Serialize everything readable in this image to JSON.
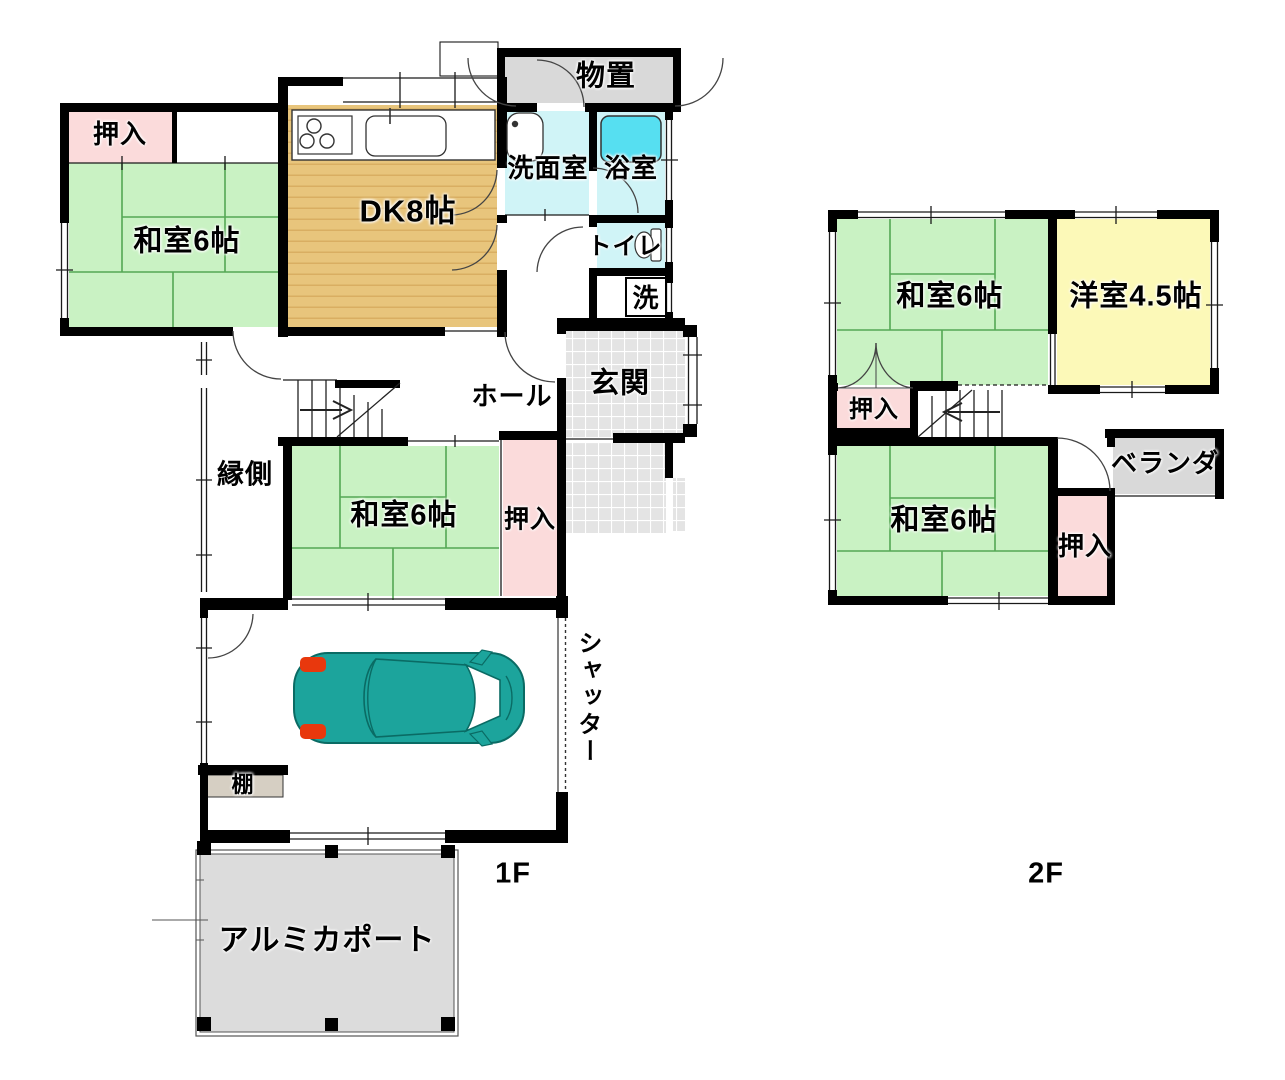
{
  "plan": {
    "f1": {
      "floor_label": "1F",
      "rooms": {
        "oshiire_nw": "押入",
        "washitsu_a": "和室6帖",
        "dk": "DK8帖",
        "monooki": "物置",
        "senmenshitsu": "洗面室",
        "yokushitsu": "浴室",
        "toire": "トイレ",
        "sen": "洗",
        "hall": "ホール",
        "genkan": "玄関",
        "engawa": "縁側",
        "washitsu_b": "和室6帖",
        "oshiire_b": "押入",
        "shutter": "シャッター",
        "tana": "棚",
        "carport": "アルミカポート"
      }
    },
    "f2": {
      "floor_label": "2F",
      "rooms": {
        "washitsu_c": "和室6帖",
        "yoshitsu": "洋室4.5帖",
        "oshiire_c": "押入",
        "veranda": "ベランダ",
        "washitsu_d": "和室6帖",
        "oshiire_d": "押入"
      }
    }
  },
  "colors": {
    "wall": "#000000",
    "tatami_green": "#c9f2c3",
    "closet_pink": "#fbdbdb",
    "wood_tan": "#e8c57c",
    "wood_stripe": "#d9ae62",
    "wet_cyan": "#d0f4f7",
    "bathtub_cyan": "#56dff1",
    "storage_gray": "#d9d9d9",
    "tile_gray": "#e4e4e4",
    "western_yellow": "#fcf9b8",
    "carport_gray": "#dcdcdc",
    "shelf_beige": "#d6cfc3",
    "car_teal": "#1ca49c",
    "car_outline": "#0a6b64",
    "car_red": "#e8380d"
  }
}
